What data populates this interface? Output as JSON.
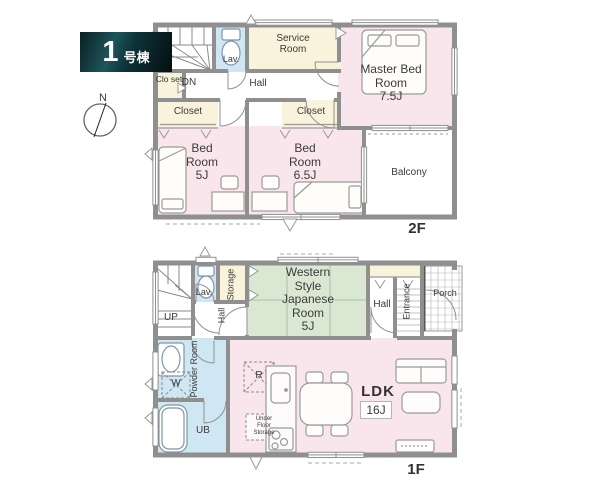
{
  "unit_label": {
    "number": "1",
    "suffix": "号棟"
  },
  "compass": {
    "north": "N"
  },
  "colors": {
    "room_pink": "#f9e6ec",
    "room_cream": "#f8f3da",
    "room_blue": "#cfe7f2",
    "room_green": "#dae8d3",
    "wall_gray": "#8f8f8f",
    "badge_teal": "#1d555c",
    "text": "#3b3b3b"
  },
  "floor2": {
    "label": "2F",
    "stairs": "DN",
    "lav": "Lav.",
    "service_room": "Service Room",
    "closet_small": "Clo set",
    "hall": "Hall",
    "closet_left": "Closet",
    "closet_right": "Closet",
    "master_bedroom": {
      "name": "Master Bed Room",
      "size": "7.5J"
    },
    "bedroom_5": {
      "name": "Bed Room",
      "size": "5J"
    },
    "bedroom_65": {
      "name": "Bed Room",
      "size": "6.5J"
    },
    "balcony": "Balcony"
  },
  "floor1": {
    "label": "1F",
    "stairs": "UP",
    "lav": "Lav.",
    "storage": "Storage",
    "hall_inner": "Hall",
    "western_room": {
      "name": "Western Style Japanese Room",
      "size": "5J"
    },
    "hall": "Hall",
    "entrance": "Entrance",
    "porch": "Porch",
    "powder_room": "Powder Room",
    "washer": "W",
    "unit_bath": "UB",
    "refrigerator": "R",
    "underfloor_storage": "Under Floor Storage",
    "ldk": {
      "name": "LDK",
      "size": "16J"
    }
  }
}
